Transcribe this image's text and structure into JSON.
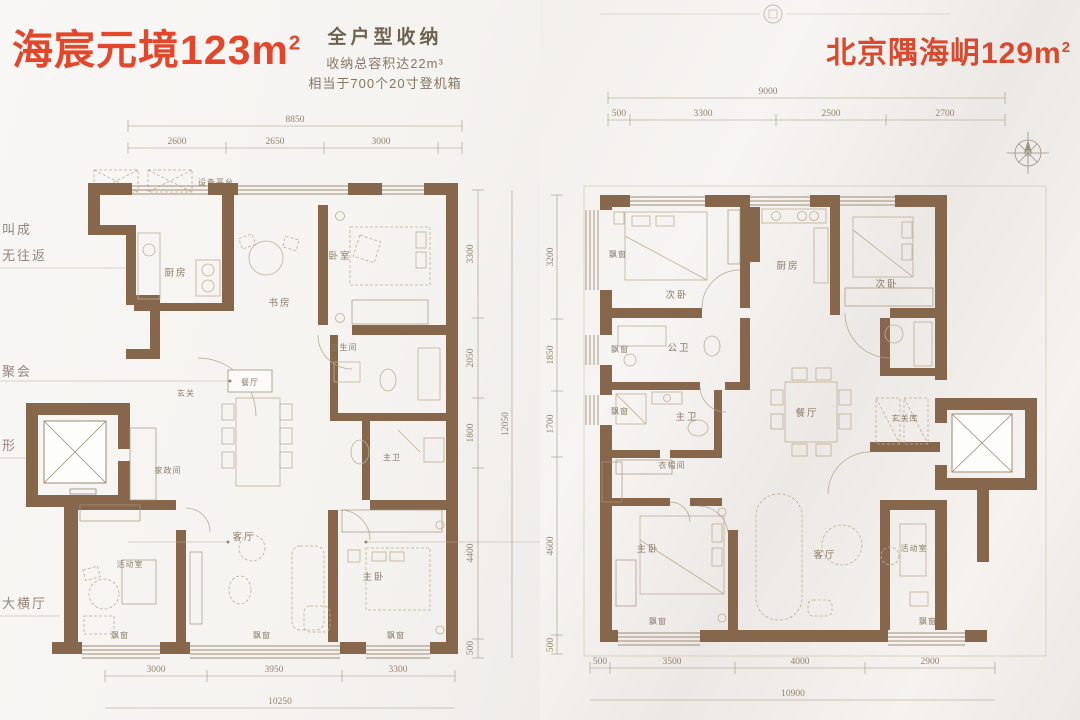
{
  "left": {
    "title": "海宸元境123m",
    "title_sup": "2",
    "storage": {
      "line1": "全户型收纳",
      "line2": "收纳总容积达22m³",
      "line3": "相当于700个20寸登机箱"
    },
    "callouts": {
      "c1": "叫成",
      "c2": "无往返",
      "c3": "聚会",
      "c4": "形",
      "c5": "大横厅"
    },
    "equip_label": "设备平台",
    "rooms": {
      "kitchen": "厨房",
      "study": "书房",
      "bedroom": "卧室",
      "bathroom": "卫生间",
      "master_bath": "主卫",
      "foyer": "玄关",
      "dining": "餐厅",
      "utility": "家政间",
      "activity": "活动室",
      "living": "客厅",
      "master_bedroom": "主卧",
      "bay": "飘窗"
    },
    "dims": {
      "top_total": "8850",
      "top": [
        "2600",
        "2650",
        "3000"
      ],
      "right": [
        "3300",
        "2050",
        "1800",
        "4400",
        "500"
      ],
      "right_total": "12050",
      "bottom": [
        "3000",
        "3950",
        "3300"
      ],
      "bottom_total": "10250"
    }
  },
  "right": {
    "title": "北京隅海岄129m",
    "title_sup": "2",
    "rooms": {
      "bedroom2": "次卧",
      "kitchen": "厨房",
      "public_bath": "公卫",
      "master_bath": "主卫",
      "closet": "衣帽间",
      "dining": "餐厅",
      "foyer_storage": "玄关库",
      "master_bedroom": "主卧",
      "living": "客厅",
      "activity": "活动室",
      "bay": "飘窗"
    },
    "dims": {
      "top_total": "9000",
      "top": [
        "500",
        "3300",
        "2500",
        "2700"
      ],
      "left": [
        "3200",
        "1850",
        "1700",
        "4600",
        "500"
      ],
      "bottom": [
        "500",
        "3500",
        "4000",
        "2900"
      ],
      "bottom_total": "10900"
    }
  }
}
